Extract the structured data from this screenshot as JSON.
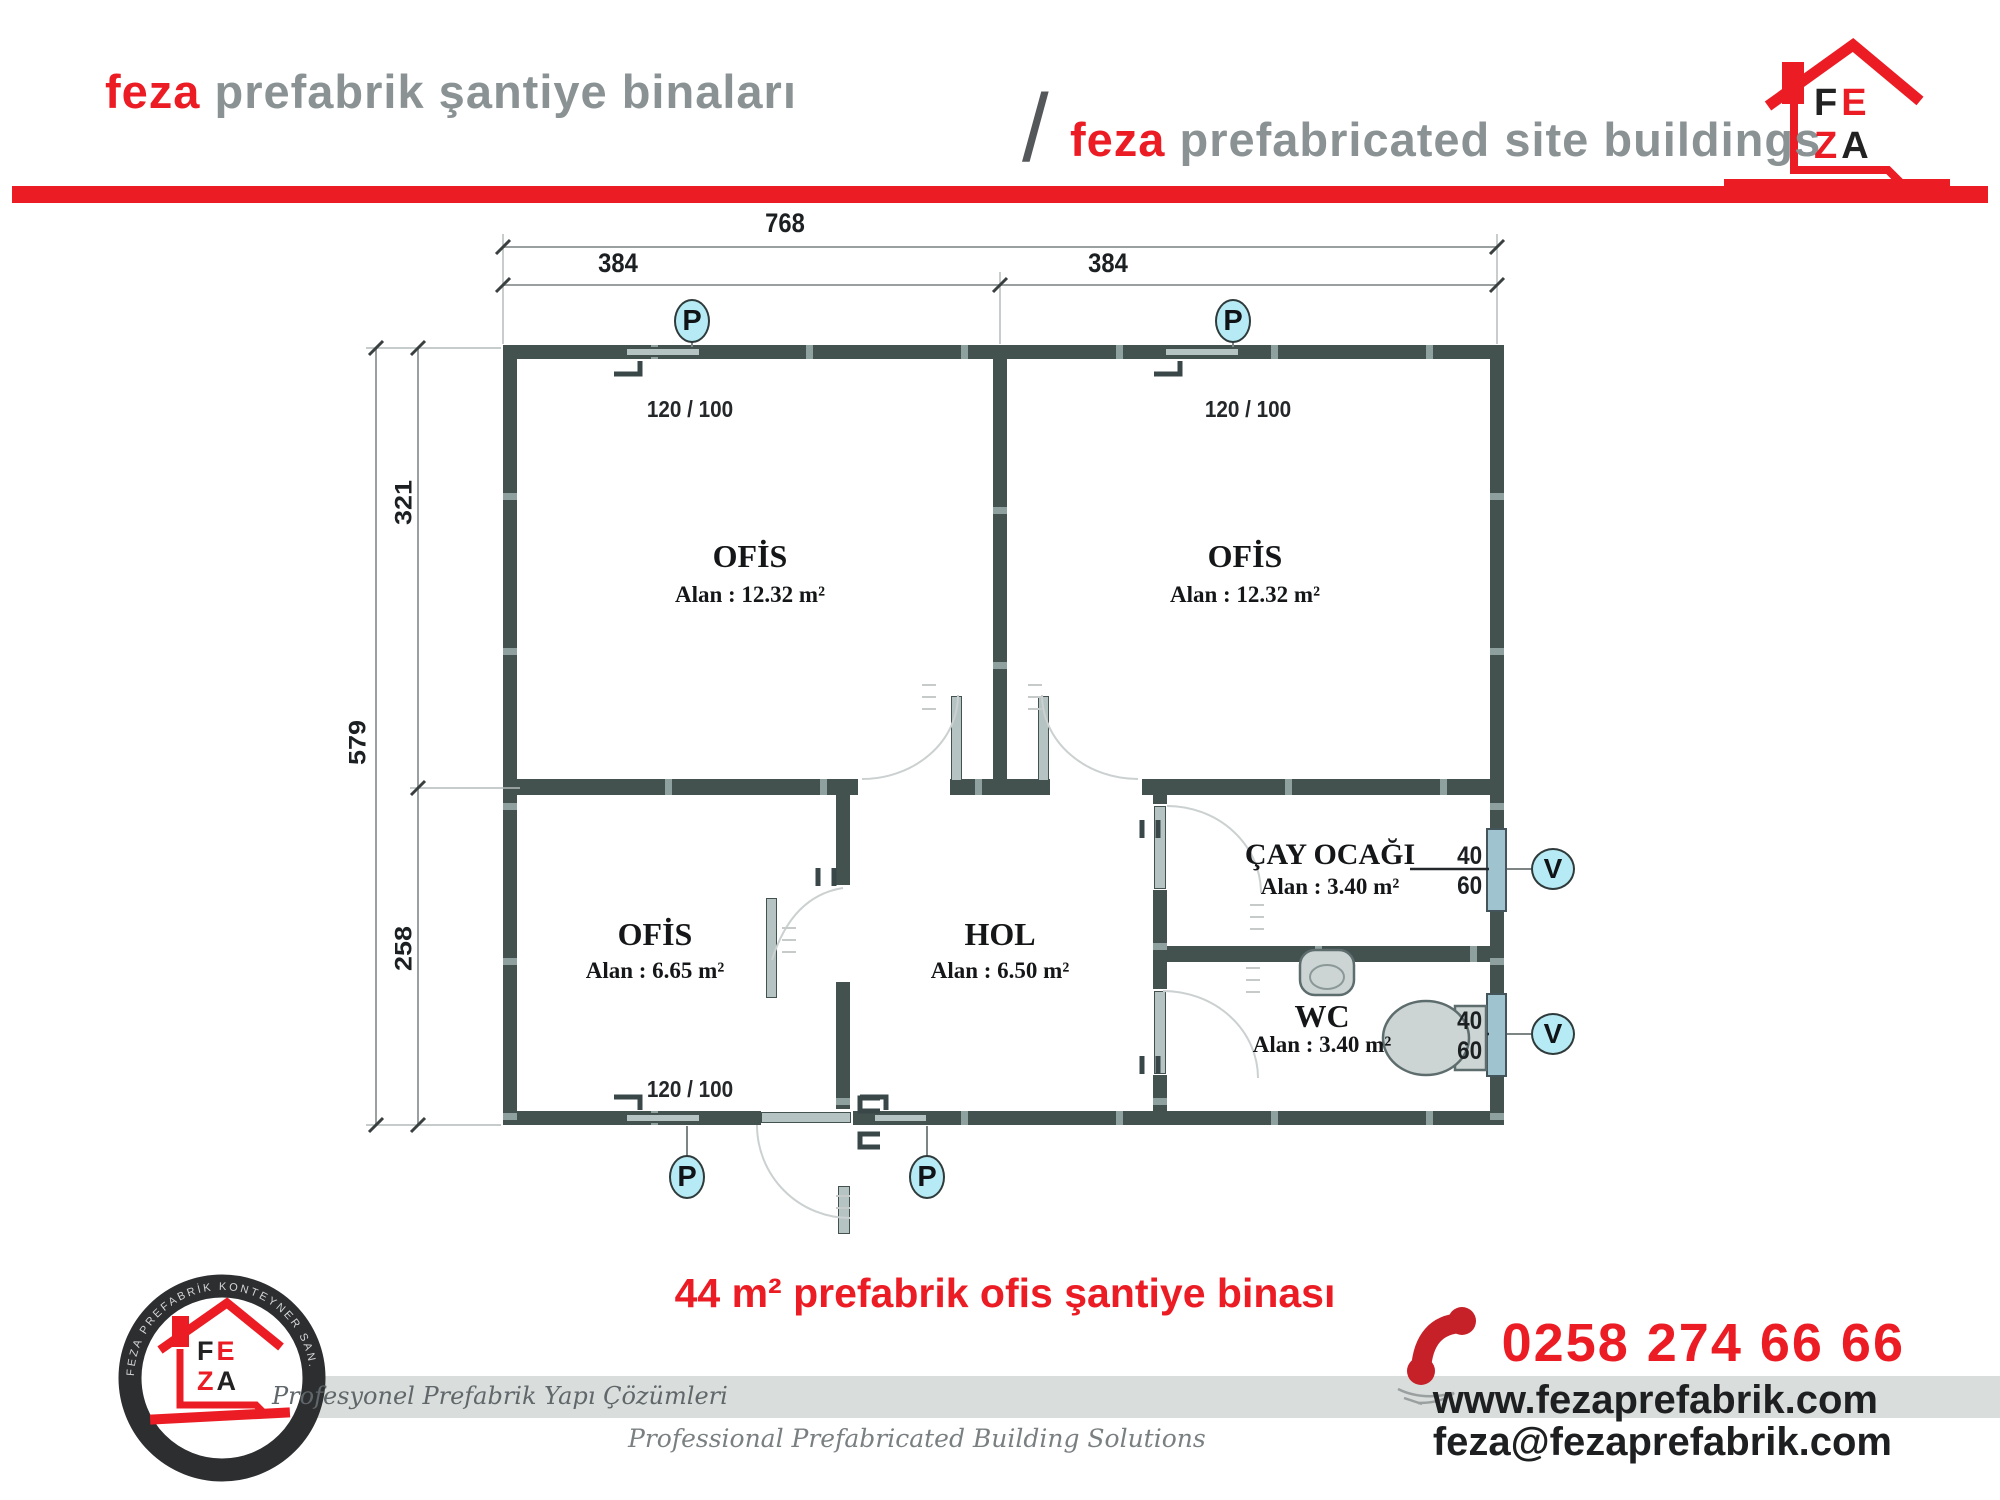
{
  "header": {
    "brand_tr": "feza",
    "title_tr": " prefabrik şantiye binaları",
    "slash": "/",
    "brand_en": "feza",
    "title_en": " prefabricated site buildings"
  },
  "logo": {
    "f": "F",
    "e": "E",
    "z": "Z",
    "a": "A"
  },
  "plan": {
    "dims": {
      "total_w": "768",
      "left_w": "384",
      "right_w": "384",
      "total_h": "579",
      "top_h": "321",
      "bottom_h": "258"
    },
    "rooms": {
      "office_tl": {
        "name": "OFİS",
        "area": "Alan : 12.32 m²"
      },
      "office_tr": {
        "name": "OFİS",
        "area": "Alan : 12.32 m²"
      },
      "office_bl": {
        "name": "OFİS",
        "area": "Alan : 6.65 m²"
      },
      "hall": {
        "name": "HOL",
        "area": "Alan : 6.50 m²"
      },
      "tea": {
        "name": "ÇAY OCAĞI",
        "area": "Alan : 3.40 m²"
      },
      "wc": {
        "name": "WC",
        "area": "Alan : 3.40 m²"
      }
    },
    "windows": {
      "label_120": "120 / 100",
      "label_40": "40",
      "label_60": "60"
    },
    "markers": {
      "p": "P",
      "v": "V"
    }
  },
  "caption": "44 m² prefabrik ofis şantiye binası",
  "footer": {
    "ring_text": "FEZA PREFABRİK KONTEYNER SAN. TİC. LTD. ŞTİ.",
    "tagline_tr": "Profesyonel Prefabrik Yapı Çözümleri",
    "tagline_en": "Professional Prefabricated Building Solutions",
    "phone": "0258 274 66 66",
    "website": "www.fezaprefabrik.com",
    "email": "feza@fezaprefabrik.com"
  },
  "colors": {
    "red": "#ec1c24",
    "header_gray": "#8a9294",
    "wall": "#43514f",
    "marker_fill": "#b6ebf6",
    "band_gray": "#d9dddb"
  }
}
